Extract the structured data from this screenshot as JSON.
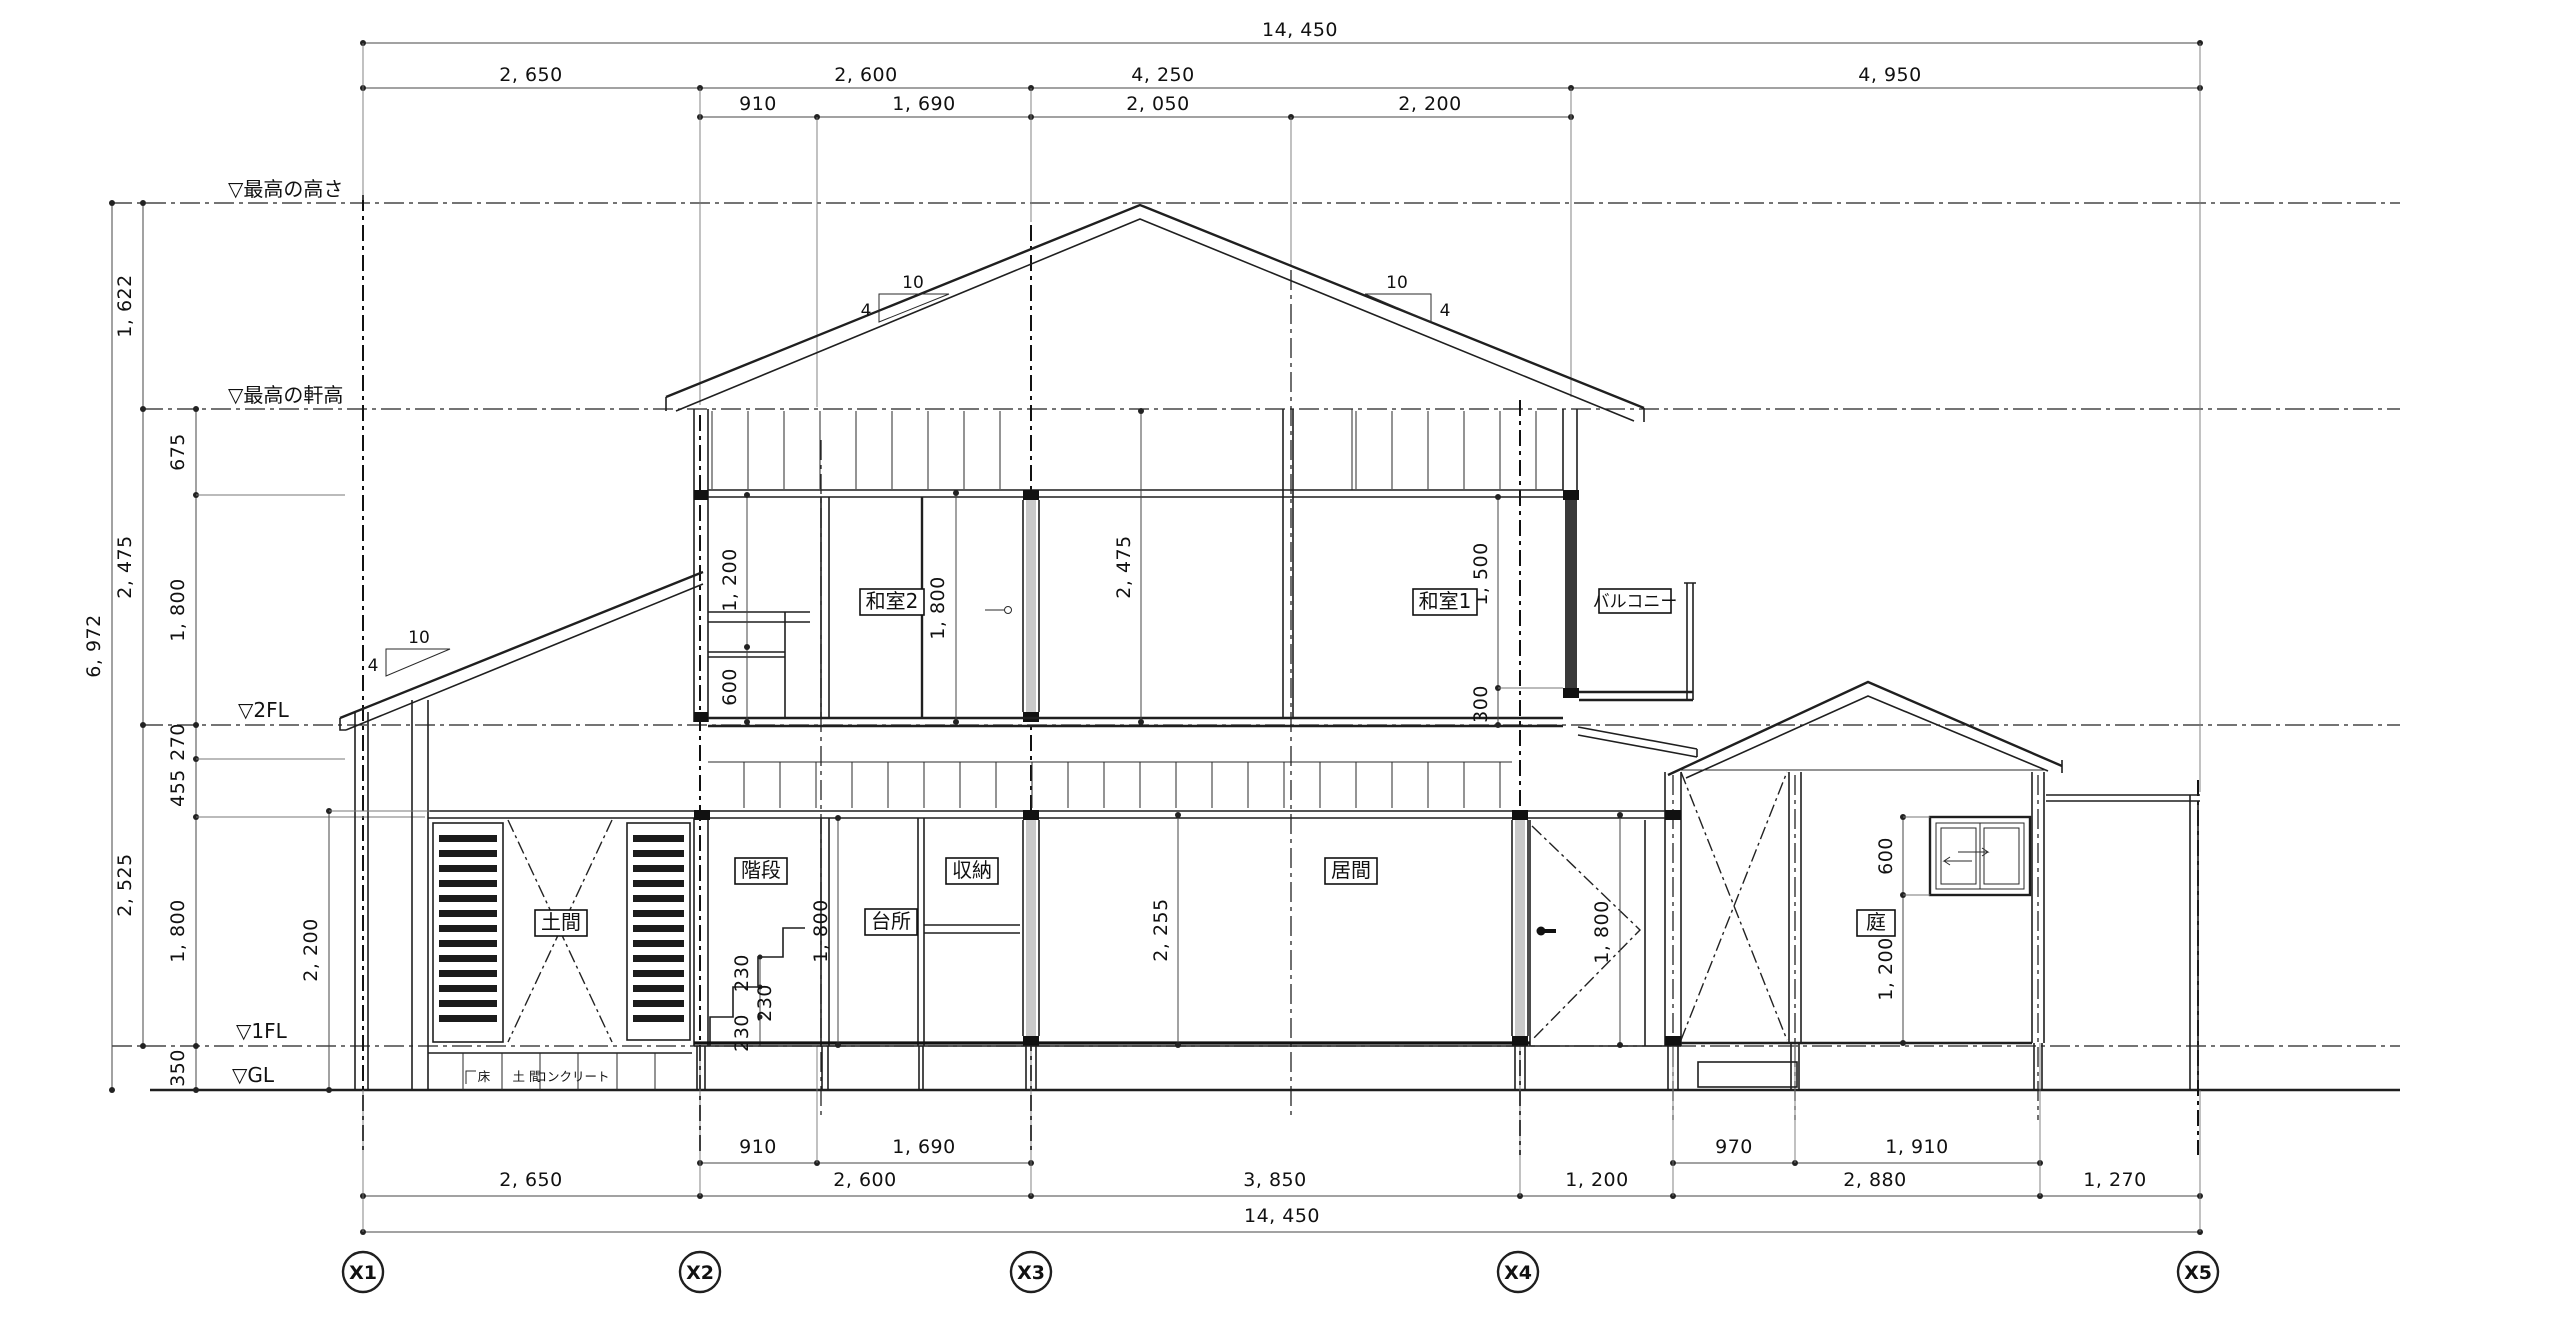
{
  "levels": {
    "max_height": "▽最高の高さ",
    "max_eave": "▽最高の軒高",
    "fl2": "▽2FL",
    "fl1": "▽1FL",
    "gl": "▽GL"
  },
  "grid_labels": [
    "X1",
    "X2",
    "X3",
    "X4",
    "X5"
  ],
  "dims_top": {
    "total": "14, 450",
    "row2": [
      "2, 650",
      "2, 600",
      "4, 250",
      "4, 950"
    ],
    "row3": [
      "910",
      "1, 690",
      "2, 050",
      "2, 200"
    ]
  },
  "dims_bottom": {
    "sub": [
      "910",
      "1, 690",
      "970",
      "1, 910"
    ],
    "main": [
      "2, 650",
      "2, 600",
      "3, 850",
      "1, 200",
      "2, 880",
      "1, 270"
    ],
    "total": "14, 450"
  },
  "dims_left": {
    "d1622": "1, 622",
    "d6972": "6, 972",
    "d675": "675",
    "d2475": "2, 475",
    "d1800_upper": "1, 800",
    "d270": "270",
    "d455": "455",
    "d2525": "2, 525",
    "d1800_lower": "1, 800",
    "d350": "350"
  },
  "dims_interior": {
    "closet_upper": "1, 200",
    "closet_lower": "600",
    "washitsu2_door": "1, 800",
    "center_height": "2, 475",
    "washitsu1_window": "1, 500",
    "balcony_sill": "300",
    "kitchen_door": "1, 800",
    "living_height": "2, 255",
    "entry_door": "1, 800",
    "doma_door": "2, 200",
    "garden_window": "600",
    "garden_sill": "1, 200",
    "riser1": "230",
    "riser2": "230",
    "riser3": "230"
  },
  "rooms": {
    "washitsu2": "和室2",
    "washitsu1": "和室1",
    "balcony": "バルコニー",
    "stairs": "階段",
    "kitchen": "台所",
    "storage": "収納",
    "living": "居間",
    "doma": "土間",
    "garden": "庭"
  },
  "slope": {
    "run": "10",
    "rise": "4"
  },
  "ground_note": {
    "floor": "床",
    "doma": "土  間",
    "concrete": "コンクリート"
  }
}
